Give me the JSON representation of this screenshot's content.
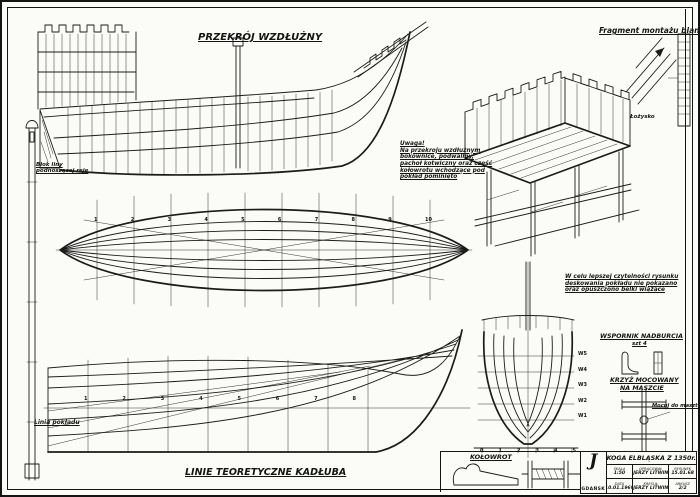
{
  "sheet": {
    "titles": {
      "longitudinal": "PRZEKRÓJ WZDŁUŻNY",
      "fragment": "Fragment montażu blanki",
      "lines_plan": "LINIE TEORETYCZNE KADŁUBA"
    },
    "labels": {
      "block_line": [
        "Blok liny",
        "podnoszącej reję"
      ],
      "deck_line": "Linia pokładu",
      "bearing": "Łożysko",
      "windlass": "KOŁOWROT",
      "bracket_title": "WSPORNIK NADBURCIA",
      "bracket_qty": "szt 4",
      "cross_title_1": "KRZYŻ MOCOWANY",
      "cross_title_2": "NA MASZCIE",
      "cross_note": "Mocuj do masztu"
    },
    "notes": {
      "uwaga": [
        "Uwaga!",
        "Na przekroju wzdłużnym",
        "bokownice, podwaliny,",
        "pachoł kotwiczny oraz część",
        "kołowrotu wchodzące pod",
        "pokład pominięto"
      ],
      "readability": [
        "W celu lepszej czytelności rysunku",
        "deskowania pokładu nie pokazano",
        "oraz opuszczono belki wiążące"
      ]
    },
    "plan_stations": [
      "1",
      "2",
      "3",
      "4",
      "5",
      "6",
      "7",
      "8",
      "9",
      "10"
    ],
    "sheer_stations": [
      "1",
      "2",
      "3",
      "4",
      "5",
      "6",
      "7",
      "8"
    ],
    "waterlines": [
      "W5",
      "W4",
      "W3",
      "W2",
      "W1"
    ],
    "body_base": [
      "0",
      "1",
      "2",
      "3",
      "4",
      "5"
    ],
    "title_block": {
      "logo": "J",
      "city": "GDAŃSK",
      "title": "KOGA ELBLĄSKA Z 1350r.",
      "fields": [
        {
          "k": "SKALA",
          "v": "1:50"
        },
        {
          "k": "OPRACOWAŁ",
          "v": "JERZY LITWIN"
        },
        {
          "k": "RYSUNEK",
          "v": "15.01.68"
        },
        {
          "k": "DATA",
          "v": "10.01.1969"
        },
        {
          "k": "KREŚLIŁ",
          "v": "JERZY LITWIN"
        },
        {
          "k": "ARKUSZ",
          "v": "2/2"
        }
      ]
    },
    "colors": {
      "ink": "#1b1b1b",
      "paper": "#fbfbf7"
    }
  }
}
